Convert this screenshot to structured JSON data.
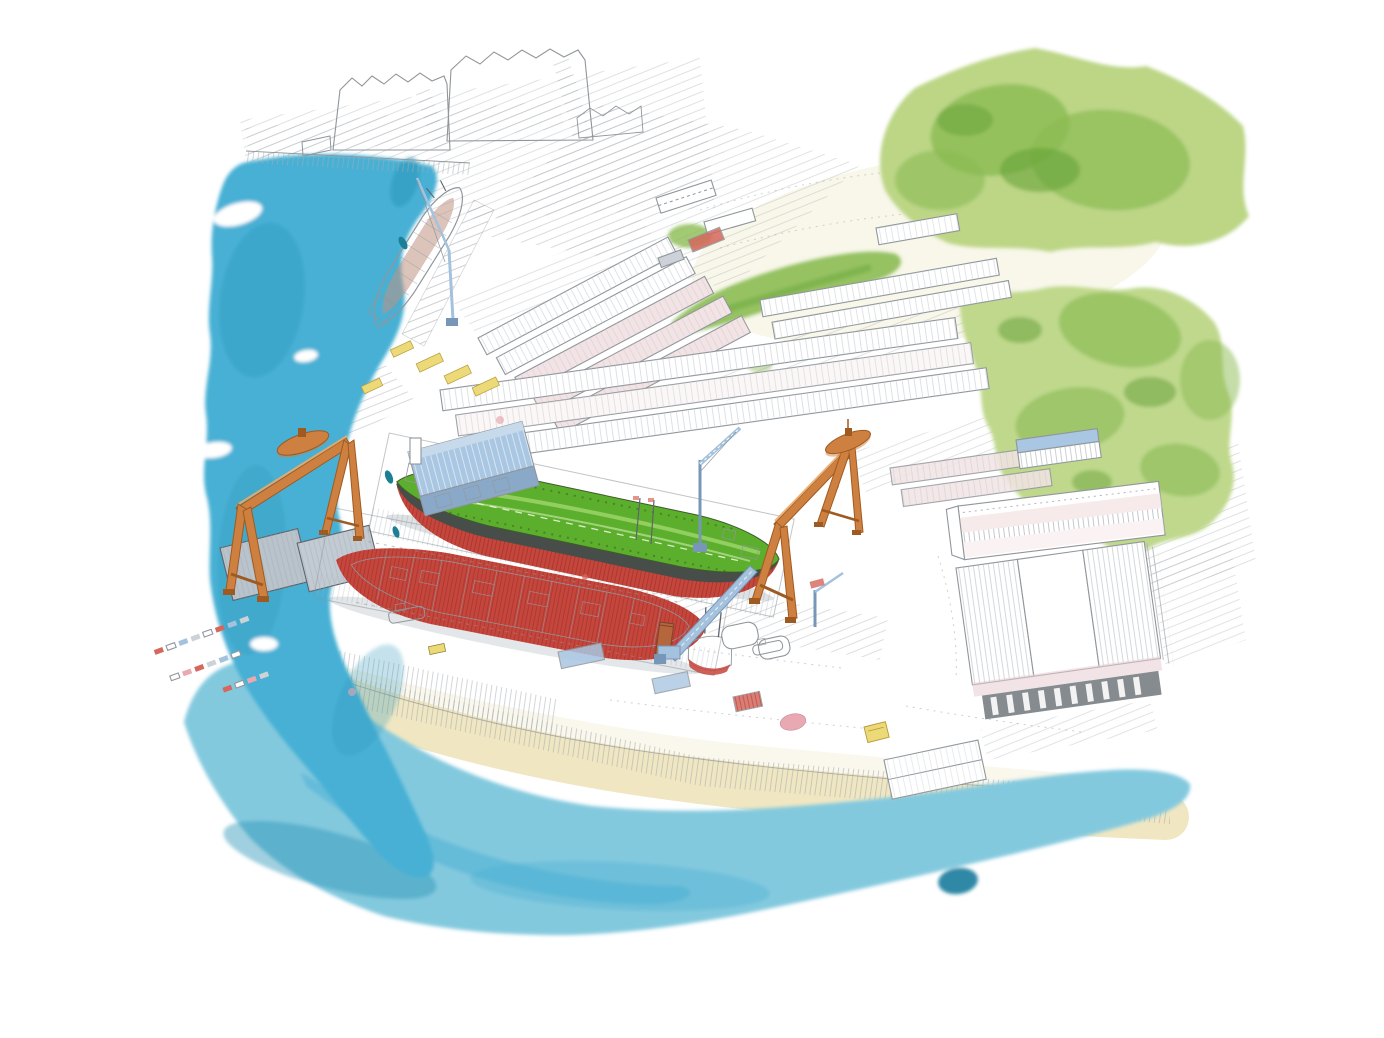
{
  "artwork": {
    "medium": "watercolor and pencil illustration",
    "subject": "aerial bird's-eye view of a coastal shipyard",
    "visible_text": ""
  },
  "palette": {
    "paper": "#ffffff",
    "pencil": "#90969b",
    "pencil_dark": "#5e646a",
    "water_main": "#47b0d4",
    "water_light": "#83c9de",
    "water_dark": "#2d97b9",
    "water_deep": "#157c9c",
    "sand": "#f0e7c2",
    "ground_cream": "#f6f1dc",
    "field_cream": "#f2f0d5",
    "green_light": "#bcd686",
    "green_mid": "#8bbb53",
    "green_dark": "#61a035",
    "hull_red": "#c5463d",
    "hull_red_deep": "#93291f",
    "deck_green": "#5caf2c",
    "deck_green_light": "#9bd36a",
    "boot_dark": "#474e49",
    "hull_unpainted": "#eef0ec",
    "crane_orange": "#cd8040",
    "crane_orange_dark": "#9f5a21",
    "crane_orange_light": "#e9ab6b",
    "roof_blue": "#a9c6e2",
    "roof_blue_wall": "#8aa9c9",
    "roof_pink": "#f3e3e4",
    "roof_pink_deep": "#e7cdd1",
    "roof_gray": "#b9c3cc",
    "wall_gray": "#ccd2d7",
    "jib_blue": "#a4c2dd",
    "jib_blue_dark": "#7897b8",
    "accent_yellow": "#ecd977",
    "accent_red": "#d5675c",
    "accent_pink": "#e8a9b2",
    "boat_teal": "#1d7f95",
    "rust_brown": "#b5663d"
  },
  "scene": {
    "water": [
      "harbor water along the left",
      "bay water along the bottom",
      "sand beach shoreline"
    ],
    "vessels": [
      "tanker with green deck and red hull in building dock",
      "second red hull under construction",
      "ship moored at fitting-out quay",
      "small workboats and buoys"
    ],
    "structures": [
      "two orange goliath gantry cranes",
      "light blue jib and tower cranes",
      "assembly hall with light blue roof",
      "rows of long warehouse sheds",
      "large gable-roofed warehouses",
      "sawtooth factory halls",
      "gray dockside sheds"
    ],
    "landscape": [
      "wooded green hillside",
      "pencil-hatched yard ground",
      "parking lots with tiny cars",
      "yellow material stacks"
    ]
  }
}
